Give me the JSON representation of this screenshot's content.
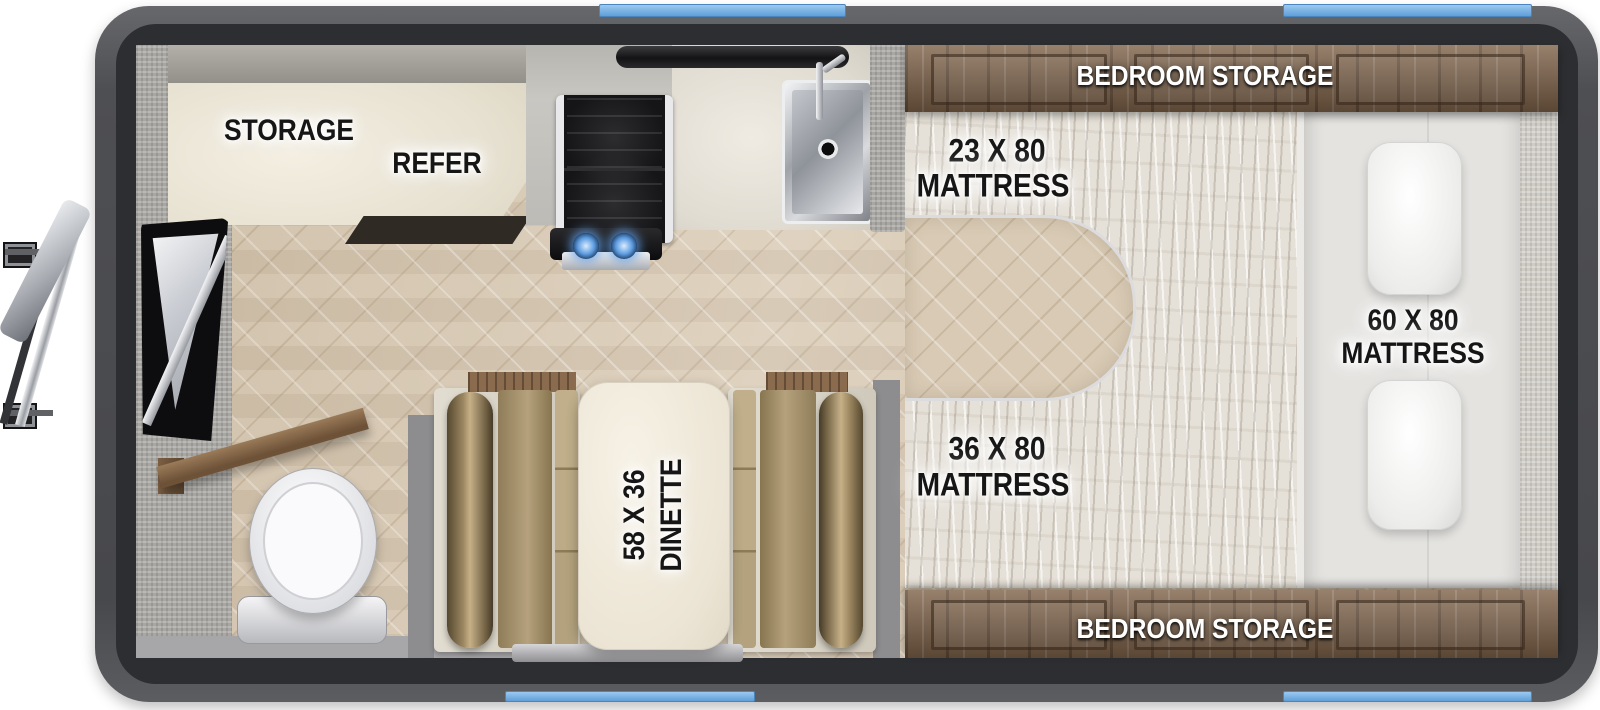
{
  "labels": {
    "storage": "STORAGE",
    "refer": "REFER",
    "bedroom_storage_top": "BEDROOM STORAGE",
    "bedroom_storage_bottom": "BEDROOM STORAGE",
    "mattress23": {
      "size": "23 X 80",
      "word": "MATTRESS"
    },
    "mattress36": {
      "size": "36 X 80",
      "word": "MATTRESS"
    },
    "mattress60": {
      "size": "60 X 80",
      "word": "MATTRESS"
    },
    "dinette": {
      "size": "58 X 36",
      "word": "DINETTE"
    }
  },
  "colors": {
    "body_frame": "#4c4d51",
    "body_border": "#2d2e31",
    "window_accent": "#7cb4e4",
    "floor_tile": "#d8cab4",
    "cabinet_wood": "#7d6148",
    "counter_cream": "#ece6d8",
    "cushion_tan": "#a5926f",
    "bolster_bronze": "#8a7a5e",
    "mattress_white": "#e6e1d8",
    "wall_gray": "#8f8f91",
    "burner_blue": "#5d9be0"
  }
}
